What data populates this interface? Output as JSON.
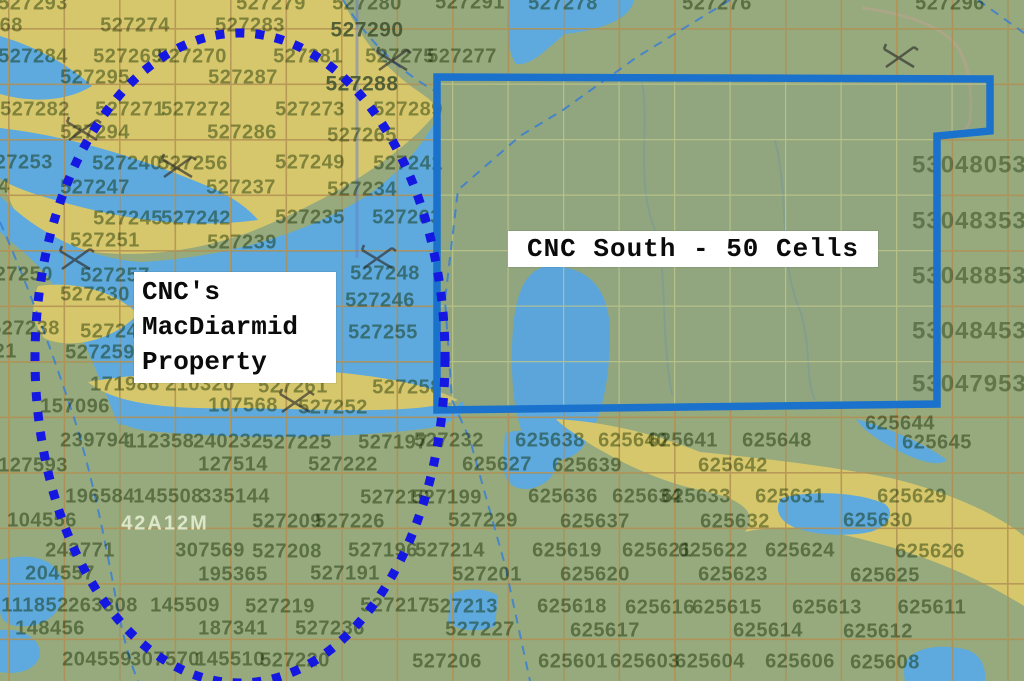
{
  "map": {
    "region_label": "42A12M",
    "labels": {
      "property": {
        "line1": "CNC's",
        "line2": "MacDiarmid",
        "line3": "Property"
      },
      "south": {
        "text": "CNC South - 50 Cells"
      }
    },
    "colors": {
      "land_green": "#97aa7d",
      "sand_yellow": "#d7c76c",
      "water_blue": "#5ea9dd",
      "boundary_blue": "#1a72cc",
      "ellipse_blue": "#1518e0",
      "claim_text": "#56703f",
      "grid_khaki": "#c8cd87",
      "grid_brown": "#a56e37"
    },
    "claim_numbers": [
      {
        "t": "527293",
        "x": 33,
        "y": 4
      },
      {
        "t": "527279",
        "x": 271,
        "y": 4
      },
      {
        "t": "527280",
        "x": 367,
        "y": 4
      },
      {
        "t": "527291",
        "x": 470,
        "y": 3
      },
      {
        "t": "527278",
        "x": 563,
        "y": 4
      },
      {
        "t": "527276",
        "x": 717,
        "y": 4
      },
      {
        "t": "527296",
        "x": 950,
        "y": 4
      },
      {
        "t": "527268",
        "x": -12,
        "y": 26
      },
      {
        "t": "527274",
        "x": 135,
        "y": 26
      },
      {
        "t": "527283",
        "x": 250,
        "y": 26
      },
      {
        "t": "527284",
        "x": 33,
        "y": 57
      },
      {
        "t": "527269",
        "x": 128,
        "y": 57
      },
      {
        "t": "527270",
        "x": 192,
        "y": 57
      },
      {
        "t": "527281",
        "x": 308,
        "y": 57
      },
      {
        "t": "527275",
        "x": 400,
        "y": 57
      },
      {
        "t": "527277",
        "x": 462,
        "y": 57
      },
      {
        "t": "527295",
        "x": 95,
        "y": 78
      },
      {
        "t": "527287",
        "x": 243,
        "y": 78
      },
      {
        "t": "527282",
        "x": 35,
        "y": 110
      },
      {
        "t": "527271",
        "x": 130,
        "y": 110
      },
      {
        "t": "527272",
        "x": 196,
        "y": 110
      },
      {
        "t": "527273",
        "x": 310,
        "y": 110
      },
      {
        "t": "527289",
        "x": 408,
        "y": 110
      },
      {
        "t": "527294",
        "x": 95,
        "y": 133
      },
      {
        "t": "527286",
        "x": 242,
        "y": 133
      },
      {
        "t": "527265",
        "x": 362,
        "y": 136
      },
      {
        "t": "527253",
        "x": 18,
        "y": 163
      },
      {
        "t": "527240",
        "x": 127,
        "y": 164
      },
      {
        "t": "527256",
        "x": 193,
        "y": 164
      },
      {
        "t": "527249",
        "x": 310,
        "y": 163
      },
      {
        "t": "527241",
        "x": 408,
        "y": 164
      },
      {
        "t": "527224",
        "x": -25,
        "y": 187
      },
      {
        "t": "527247",
        "x": 95,
        "y": 188
      },
      {
        "t": "527237",
        "x": 241,
        "y": 188
      },
      {
        "t": "527234",
        "x": 362,
        "y": 190
      },
      {
        "t": "527245",
        "x": 128,
        "y": 219
      },
      {
        "t": "527242",
        "x": 196,
        "y": 219
      },
      {
        "t": "527235",
        "x": 310,
        "y": 218
      },
      {
        "t": "527263",
        "x": 407,
        "y": 218
      },
      {
        "t": "527251",
        "x": 105,
        "y": 241
      },
      {
        "t": "527239",
        "x": 242,
        "y": 243
      },
      {
        "t": "527250",
        "x": 18,
        "y": 275
      },
      {
        "t": "527257",
        "x": 115,
        "y": 276
      },
      {
        "t": "527248",
        "x": 385,
        "y": 274
      },
      {
        "t": "527230",
        "x": 95,
        "y": 295
      },
      {
        "t": "527246",
        "x": 380,
        "y": 301
      },
      {
        "t": "527238",
        "x": 25,
        "y": 329
      },
      {
        "t": "527243",
        "x": 115,
        "y": 332
      },
      {
        "t": "527255",
        "x": 383,
        "y": 333
      },
      {
        "t": "527221",
        "x": -18,
        "y": 352
      },
      {
        "t": "527259",
        "x": 100,
        "y": 353
      },
      {
        "t": "171986",
        "x": 125,
        "y": 385
      },
      {
        "t": "210320",
        "x": 200,
        "y": 385
      },
      {
        "t": "527261",
        "x": 293,
        "y": 387
      },
      {
        "t": "527258",
        "x": 407,
        "y": 388
      },
      {
        "t": "157096",
        "x": 75,
        "y": 407
      },
      {
        "t": "107568",
        "x": 243,
        "y": 406
      },
      {
        "t": "527252",
        "x": 333,
        "y": 408
      },
      {
        "t": "239794",
        "x": 95,
        "y": 441
      },
      {
        "t": "112358",
        "x": 160,
        "y": 442
      },
      {
        "t": "240232",
        "x": 228,
        "y": 442
      },
      {
        "t": "527225",
        "x": 297,
        "y": 443
      },
      {
        "t": "527197",
        "x": 393,
        "y": 443
      },
      {
        "t": "527232",
        "x": 449,
        "y": 441
      },
      {
        "t": "625638",
        "x": 550,
        "y": 441
      },
      {
        "t": "625640",
        "x": 633,
        "y": 441
      },
      {
        "t": "625641",
        "x": 683,
        "y": 441
      },
      {
        "t": "625648",
        "x": 777,
        "y": 441
      },
      {
        "t": "625644",
        "x": 900,
        "y": 424
      },
      {
        "t": "625645",
        "x": 937,
        "y": 443
      },
      {
        "t": "127593",
        "x": 33,
        "y": 466
      },
      {
        "t": "127514",
        "x": 233,
        "y": 465
      },
      {
        "t": "527222",
        "x": 343,
        "y": 465
      },
      {
        "t": "625627",
        "x": 497,
        "y": 465
      },
      {
        "t": "625639",
        "x": 587,
        "y": 466
      },
      {
        "t": "625642",
        "x": 733,
        "y": 466
      },
      {
        "t": "196584",
        "x": 100,
        "y": 497
      },
      {
        "t": "145508",
        "x": 168,
        "y": 497
      },
      {
        "t": "335144",
        "x": 235,
        "y": 497
      },
      {
        "t": "527210",
        "x": 395,
        "y": 498
      },
      {
        "t": "527199",
        "x": 447,
        "y": 498
      },
      {
        "t": "625636",
        "x": 563,
        "y": 497
      },
      {
        "t": "625634",
        "x": 647,
        "y": 497
      },
      {
        "t": "625633",
        "x": 696,
        "y": 497
      },
      {
        "t": "625631",
        "x": 790,
        "y": 497
      },
      {
        "t": "625629",
        "x": 912,
        "y": 497
      },
      {
        "t": "104556",
        "x": 42,
        "y": 521
      },
      {
        "t": "527209",
        "x": 287,
        "y": 522
      },
      {
        "t": "527226",
        "x": 350,
        "y": 522
      },
      {
        "t": "527229",
        "x": 483,
        "y": 521
      },
      {
        "t": "625637",
        "x": 595,
        "y": 522
      },
      {
        "t": "625632",
        "x": 735,
        "y": 522
      },
      {
        "t": "625630",
        "x": 878,
        "y": 521
      },
      {
        "t": "243771",
        "x": 80,
        "y": 551
      },
      {
        "t": "307569",
        "x": 210,
        "y": 551
      },
      {
        "t": "527208",
        "x": 287,
        "y": 552
      },
      {
        "t": "527196",
        "x": 383,
        "y": 551
      },
      {
        "t": "527214",
        "x": 450,
        "y": 551
      },
      {
        "t": "625619",
        "x": 567,
        "y": 551
      },
      {
        "t": "625621",
        "x": 657,
        "y": 551
      },
      {
        "t": "625622",
        "x": 713,
        "y": 551
      },
      {
        "t": "625624",
        "x": 800,
        "y": 551
      },
      {
        "t": "625626",
        "x": 930,
        "y": 552
      },
      {
        "t": "204557",
        "x": 60,
        "y": 574
      },
      {
        "t": "195365",
        "x": 233,
        "y": 575
      },
      {
        "t": "527191",
        "x": 345,
        "y": 574
      },
      {
        "t": "527201",
        "x": 487,
        "y": 575
      },
      {
        "t": "625620",
        "x": 595,
        "y": 575
      },
      {
        "t": "625623",
        "x": 733,
        "y": 575
      },
      {
        "t": "625625",
        "x": 885,
        "y": 576
      },
      {
        "t": "111852",
        "x": 35,
        "y": 606
      },
      {
        "t": "263308",
        "x": 103,
        "y": 606
      },
      {
        "t": "145509",
        "x": 185,
        "y": 606
      },
      {
        "t": "527219",
        "x": 280,
        "y": 607
      },
      {
        "t": "527217",
        "x": 395,
        "y": 606
      },
      {
        "t": "527213",
        "x": 463,
        "y": 607
      },
      {
        "t": "625618",
        "x": 572,
        "y": 607
      },
      {
        "t": "625616",
        "x": 660,
        "y": 608
      },
      {
        "t": "625615",
        "x": 727,
        "y": 608
      },
      {
        "t": "625613",
        "x": 827,
        "y": 608
      },
      {
        "t": "625611",
        "x": 932,
        "y": 608
      },
      {
        "t": "148456",
        "x": 50,
        "y": 629
      },
      {
        "t": "187341",
        "x": 233,
        "y": 629
      },
      {
        "t": "527236",
        "x": 330,
        "y": 629
      },
      {
        "t": "527227",
        "x": 480,
        "y": 630
      },
      {
        "t": "625617",
        "x": 605,
        "y": 631
      },
      {
        "t": "625614",
        "x": 768,
        "y": 631
      },
      {
        "t": "625612",
        "x": 878,
        "y": 632
      },
      {
        "t": "204559",
        "x": 97,
        "y": 660
      },
      {
        "t": "307570",
        "x": 165,
        "y": 660
      },
      {
        "t": "145510",
        "x": 230,
        "y": 660
      },
      {
        "t": "527220",
        "x": 295,
        "y": 661
      },
      {
        "t": "527206",
        "x": 447,
        "y": 662
      },
      {
        "t": "625601",
        "x": 573,
        "y": 662
      },
      {
        "t": "625603",
        "x": 645,
        "y": 662
      },
      {
        "t": "625604",
        "x": 710,
        "y": 662
      },
      {
        "t": "625606",
        "x": 800,
        "y": 662
      },
      {
        "t": "625608",
        "x": 885,
        "y": 663
      }
    ],
    "right_column_numbers": [
      {
        "t": "5304805304",
        "x": 912,
        "y": 166
      },
      {
        "t": "5304835304",
        "x": 912,
        "y": 222
      },
      {
        "t": "5304885304",
        "x": 912,
        "y": 277
      },
      {
        "t": "5304845304",
        "x": 912,
        "y": 332
      },
      {
        "t": "5304795304",
        "x": 912,
        "y": 385
      }
    ],
    "dark_numbers": [
      {
        "t": "527290",
        "x": 367,
        "y": 31
      },
      {
        "t": "527288",
        "x": 362,
        "y": 85
      }
    ],
    "pick_markers": [
      {
        "x": 82,
        "y": 130
      },
      {
        "x": 392,
        "y": 60
      },
      {
        "x": 177,
        "y": 167
      },
      {
        "x": 75,
        "y": 259
      },
      {
        "x": 377,
        "y": 258
      },
      {
        "x": 295,
        "y": 402
      },
      {
        "x": 899,
        "y": 57
      }
    ]
  }
}
